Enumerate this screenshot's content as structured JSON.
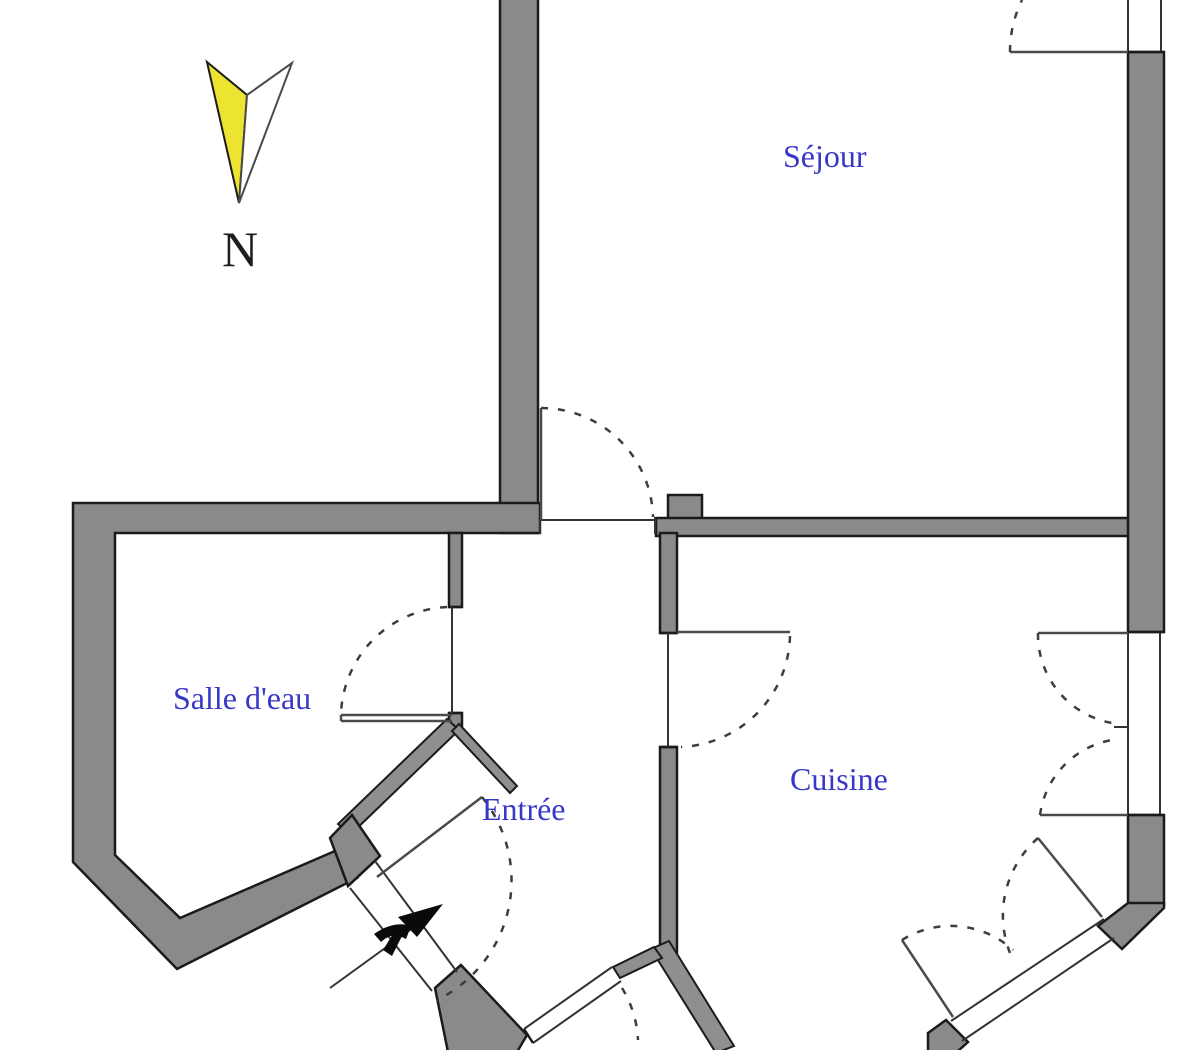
{
  "plan": {
    "type": "apartment-floor-plan",
    "rooms": [
      {
        "id": "sejour",
        "label": "Séjour"
      },
      {
        "id": "salle-deau",
        "label": "Salle d'eau"
      },
      {
        "id": "entree",
        "label": "Entrée"
      },
      {
        "id": "cuisine",
        "label": "Cuisine"
      }
    ],
    "compass": {
      "label": "N",
      "direction": "north",
      "needle_colors": [
        "#ece431",
        "#ffffff"
      ]
    },
    "colors": {
      "wall_fill": "#8a8a8a",
      "wall_outline": "#1b1b1b",
      "label_blue": "#3838c8",
      "compass_yellow": "#ece431",
      "background": "#ffffff"
    },
    "features": [
      "dashed door swing arcs",
      "double casement window on east wall",
      "entrance direction arrow",
      "diagonal entrance vestibule walls"
    ]
  }
}
